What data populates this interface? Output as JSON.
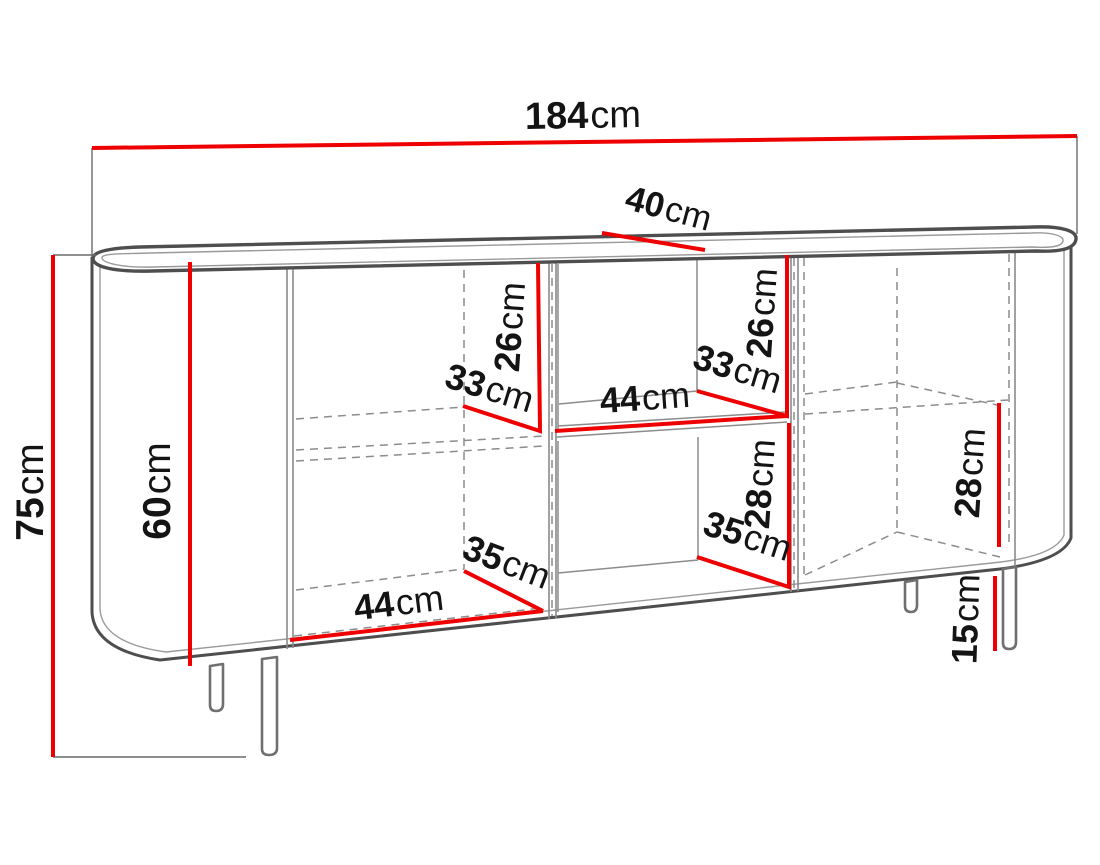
{
  "diagram": {
    "unit": "cm",
    "colors": {
      "dimension_line": "#ee0000",
      "drawing_outline": "#4e4e4e",
      "hidden_edge": "#8c8c8c",
      "label_text": "#141414"
    },
    "labels": {
      "width_total": {
        "value": "184",
        "unit": "cm"
      },
      "depth_top": {
        "value": "40",
        "unit": "cm"
      },
      "height_total": {
        "value": "75",
        "unit": "cm"
      },
      "height_interior": {
        "value": "60",
        "unit": "cm"
      },
      "left_shelf_height": {
        "value": "26",
        "unit": "cm"
      },
      "left_shelf_depth": {
        "value": "33",
        "unit": "cm"
      },
      "niche_top_width": {
        "value": "44",
        "unit": "cm"
      },
      "niche_top_depth": {
        "value": "33",
        "unit": "cm"
      },
      "niche_top_height": {
        "value": "26",
        "unit": "cm"
      },
      "niche_bottom_height": {
        "value": "28",
        "unit": "cm"
      },
      "niche_bottom_depth": {
        "value": "35",
        "unit": "cm"
      },
      "left_bottom_width": {
        "value": "44",
        "unit": "cm"
      },
      "left_bottom_depth": {
        "value": "35",
        "unit": "cm"
      },
      "right_bottom_height": {
        "value": "28",
        "unit": "cm"
      },
      "leg_height": {
        "value": "15",
        "unit": "cm"
      }
    }
  }
}
